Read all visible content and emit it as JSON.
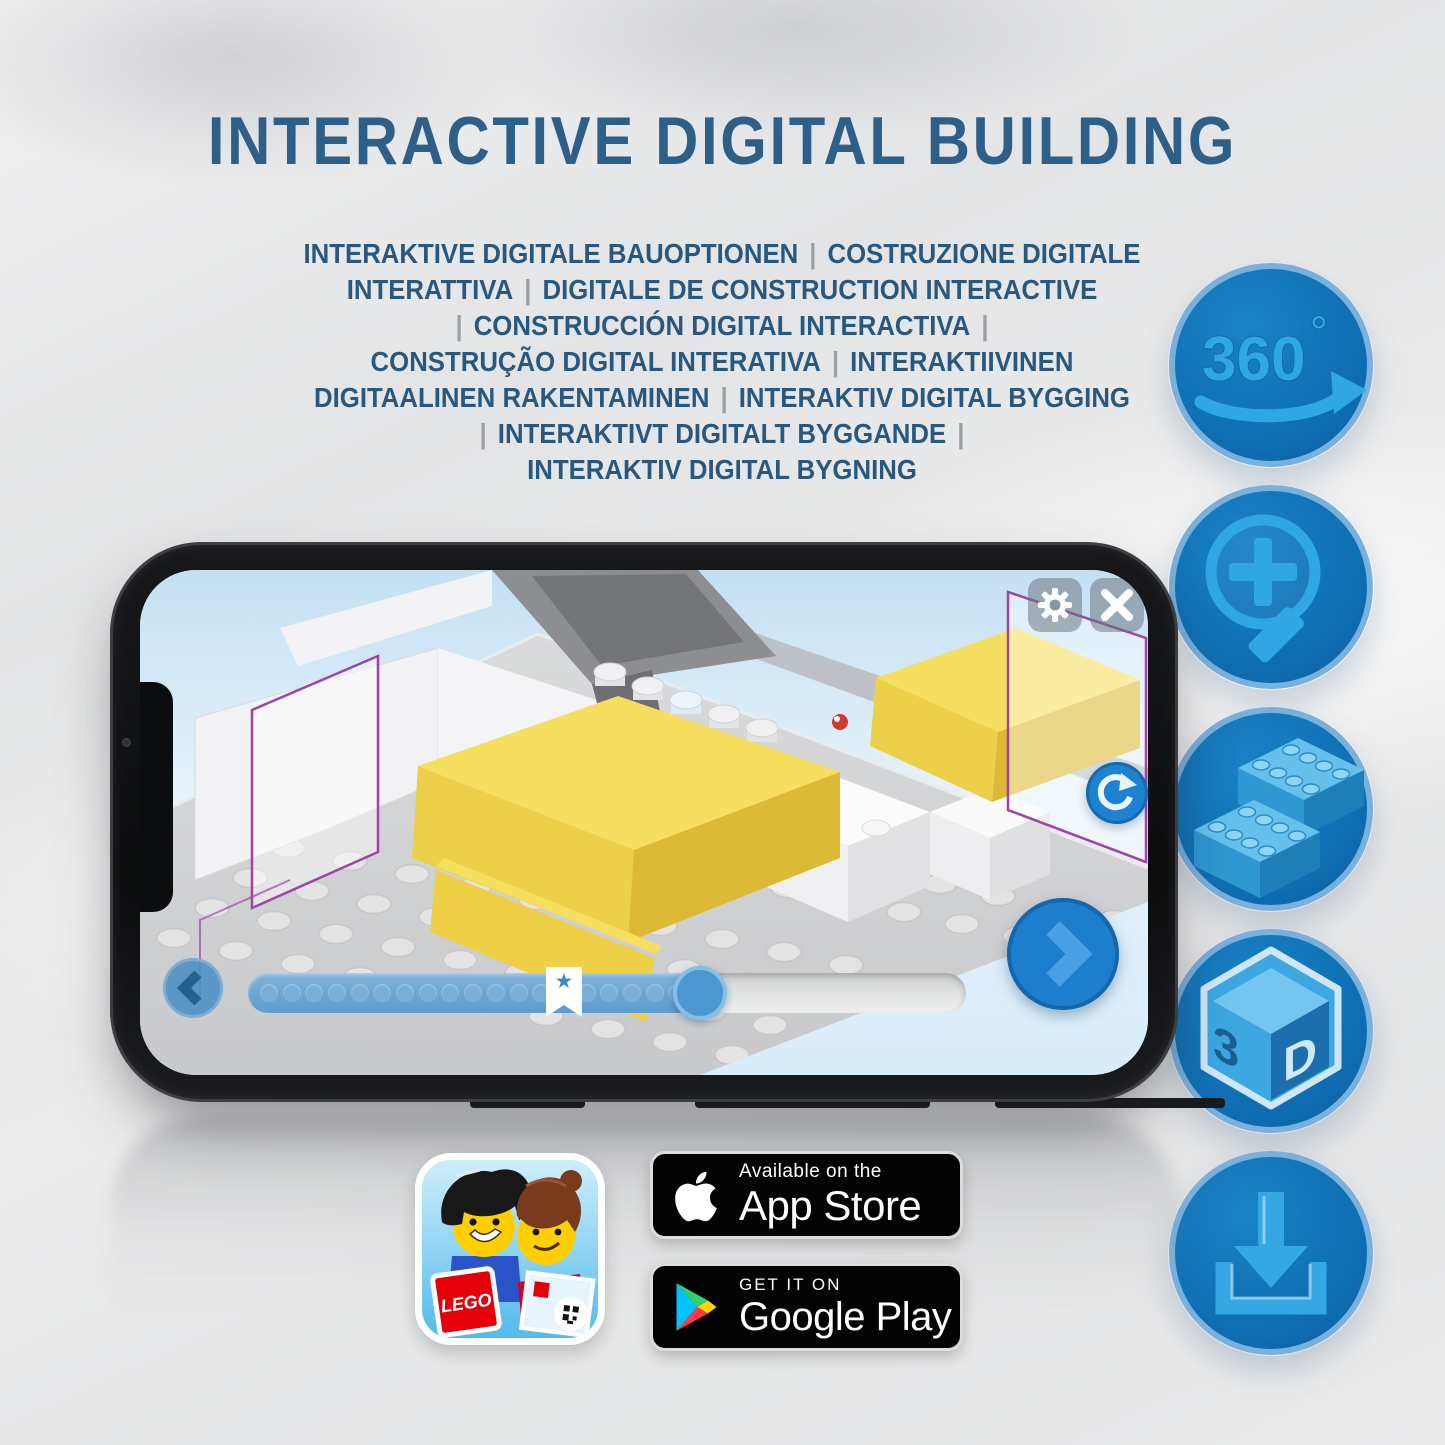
{
  "header": {
    "title": "INTERACTIVE DIGITAL BUILDING",
    "title_color": "#2e5f88",
    "subtitle_lines": [
      "INTERAKTIVE DIGITALE BAUOPTIONEN | COSTRUZIONE DIGITALE",
      "INTERATTIVA | DIGITALE DE CONSTRUCTION INTERACTIVE",
      "| CONSTRUCCIÓN DIGITAL INTERACTIVA |",
      "CONSTRUÇÃO DIGITAL INTERATIVA | INTERAKTIIVINEN",
      "DIGITAALINEN RAKENTAMINEN | INTERAKTIV DIGITAL BYGGING",
      "| INTERAKTIVT DIGITALT BYGGANDE |",
      "INTERAKTIV DIGITAL BYGNING"
    ]
  },
  "feature_icons": {
    "accent": "#2ea4e2",
    "circle_fill": "#0f6fb4",
    "ring": "#79b0dc",
    "rotation_360": {
      "label": "360",
      "degree": "°"
    },
    "view_3d": {
      "left": "3",
      "right": "D"
    }
  },
  "phone": {
    "bezel_color": "#101113",
    "app": {
      "toolbar": {
        "settings_icon": "gear",
        "close_icon": "close"
      },
      "nav": {
        "prev_icon": "chevron-left",
        "next_icon": "chevron-right",
        "rotate_icon": "rotate-arrow"
      },
      "slider": {
        "dots": 19,
        "progress_pct": 63,
        "bookmark_pct": 44
      }
    }
  },
  "store": {
    "app_store": {
      "tagline": "Available on the",
      "name": "App Store"
    },
    "google_play": {
      "tagline": "GET IT ON",
      "name": "Google Play"
    },
    "lego_app": {
      "brand": "LEGO"
    }
  }
}
